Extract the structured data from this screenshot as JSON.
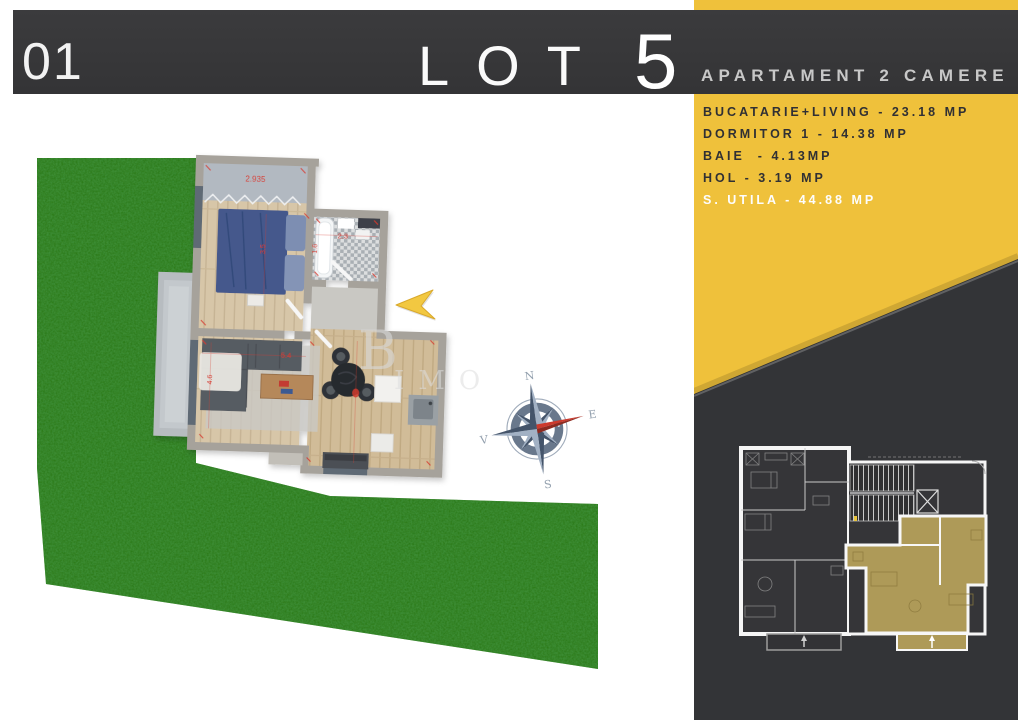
{
  "page_number": "01",
  "header": {
    "lot_label": "LOT",
    "lot_number": "5",
    "subtitle": "APARTAMENT 2 CAMERE"
  },
  "room_list": [
    "BUCATARIE+LIVING - 23.18 MP",
    "DORMITOR 1 - 14.38 MP",
    "BAIE  - 4.13MP",
    "HOL - 3.19 MP",
    "S. UTILA - 44.88 MP"
  ],
  "plan": {
    "dimensions": {
      "wardrobe_width": "2.935",
      "bath_width": "2.3",
      "bath_height": "1.6",
      "bed_width": "3.5",
      "living_width": "5.4",
      "living_height": "4.6"
    },
    "compass": {
      "north": "N",
      "east": "E",
      "south": "S",
      "west": "V"
    },
    "watermark": {
      "initial": "B",
      "letters": "IMO"
    }
  },
  "colors": {
    "accent_yellow": "#EFC13B",
    "banner_dark": "#38383A",
    "panel_dark": "#333437",
    "gold_highlight": "#AE9A58",
    "grass_green": "#2D7A1D",
    "dimension_red": "#D6372C"
  }
}
